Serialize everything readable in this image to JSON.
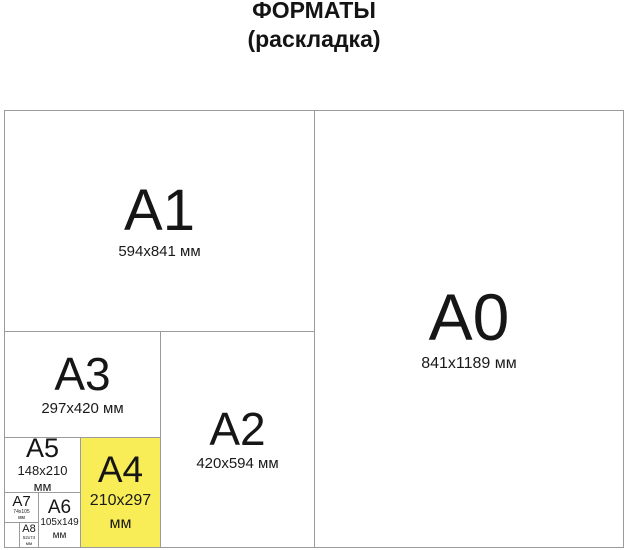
{
  "title": {
    "line1": "ФОРМАТЫ",
    "line2": "(раскладка)"
  },
  "colors": {
    "background": "#ffffff",
    "border": "#9b9b9b",
    "text": "#1a1a1a",
    "highlight": "#f8ed56"
  },
  "formats": {
    "a0": {
      "label": "A0",
      "dims": "841x1189 мм"
    },
    "a1": {
      "label": "A1",
      "dims": "594x841 мм"
    },
    "a2": {
      "label": "A2",
      "dims": "420x594 мм"
    },
    "a3": {
      "label": "A3",
      "dims": "297x420 мм"
    },
    "a4": {
      "label": "A4",
      "dims1": "210x297",
      "dims2": "мм"
    },
    "a5": {
      "label": "A5",
      "dims1": "148x210",
      "dims2": "мм"
    },
    "a6": {
      "label": "A6",
      "dims1": "105x149",
      "dims2": "мм"
    },
    "a7": {
      "label": "A7",
      "dims1": "74x105",
      "dims2": "мм"
    },
    "a8": {
      "label": "A8",
      "dims1": "52x74",
      "dims2": "мм"
    }
  }
}
